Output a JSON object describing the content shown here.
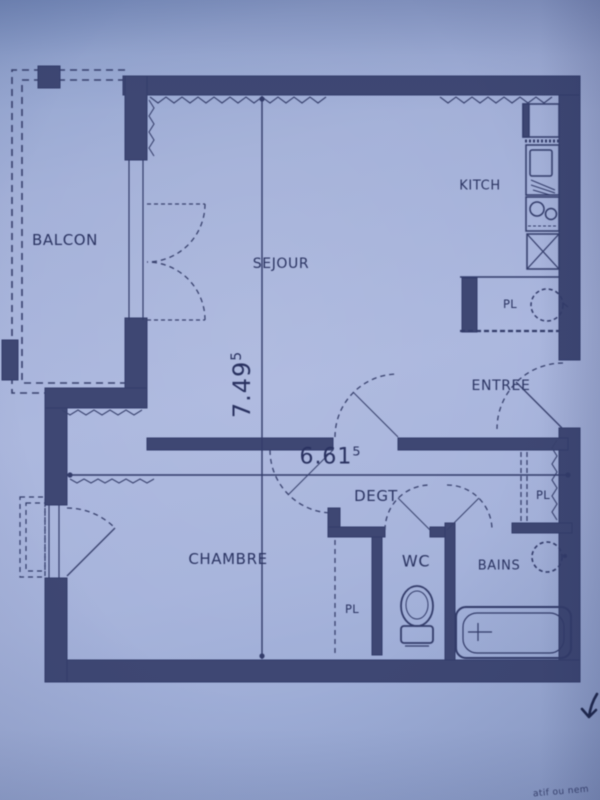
{
  "document": {
    "type": "apartment floor plan (scanned photo)",
    "corner_note_fragment": "atif ou nem"
  },
  "colors": {
    "paper": "#a3b0d8",
    "ink": "#333c6a",
    "wall_fill": "#3e4773",
    "label": "#2b3462"
  },
  "labels": {
    "balcon": "BALCON",
    "sejour": "SEJOUR",
    "kitchen": "KITCH",
    "entree": "ENTREE",
    "degagement": "DEGT",
    "chambre": "CHAMBRE",
    "wc": "WC",
    "bains": "BAINS",
    "pl_kitchen": "PL",
    "pl_bains": "PL",
    "pl_chambre": "PL"
  },
  "dimensions": {
    "height_m": {
      "value": "7.49",
      "superscript": "5"
    },
    "width_m": {
      "value": "6.61",
      "superscript": "5"
    }
  }
}
